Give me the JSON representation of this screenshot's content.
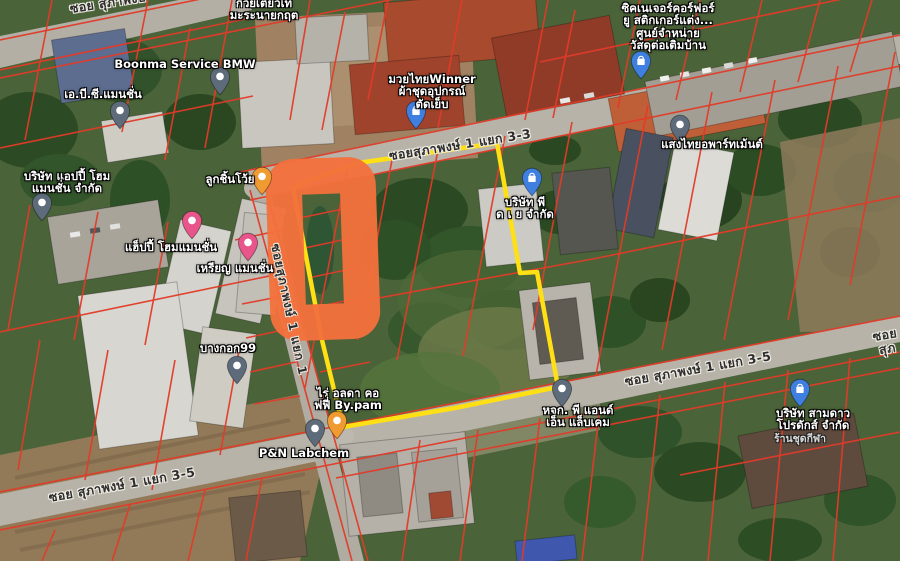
{
  "map": {
    "type": "satellite-with-cadastral-overlay",
    "overlays": {
      "parcel_line_color": "#e23b28",
      "plot_outline_color": "#ffe014",
      "highlight_marker_color": "#f3703c",
      "pin_generic_color": "#5d6b7b",
      "pin_shop_color": "#3f7fe0",
      "pin_food_color": "#f09a32",
      "pin_lodging_color": "#e8558a"
    },
    "road_labels": [
      {
        "text": "ซอย สุภาพงษ์"
      },
      {
        "text": "ซอยสุภาพงษ์ 1 แยก 3-3"
      },
      {
        "text": "ซอยสุภาพงษ์ 1 แยก 1"
      },
      {
        "text": "ซอย สุภาพงษ์ 1 แยก 3-5"
      },
      {
        "text": "ซอย สุภาพงษ์ 1 แยก 3-5"
      },
      {
        "text": "ซอย สุภ"
      }
    ],
    "pois": [
      {
        "name": "Boonma Service BMW",
        "pin": "generic"
      },
      {
        "name": "ก๋วยเตี๋ยวเท\nมะระนายกฤต",
        "pin": "none"
      },
      {
        "name": "เอ.บี.ซี.แมนชั่น",
        "pin": "generic"
      },
      {
        "name": "บริษัท แอปปี้ โฮม\nแมนชั่น จำกัด",
        "pin": "generic"
      },
      {
        "name": "ซิคเนเจอร์คอร์ฟอร์\nยู สติกเกอร์แต่ง...\nศูนย์จำหน่าย\nวัสดุต่อเติมบ้าน",
        "pin": "shop"
      },
      {
        "name": "มวยไทยWinner\nผ้าชุดอุปกรณ์\nตัดเย็บ",
        "pin": "shop"
      },
      {
        "name": "แสงไทยอพาร์ทเม้นต์",
        "pin": "generic"
      },
      {
        "name": "ลูกชิ้นโว้ย",
        "pin": "food"
      },
      {
        "name": "แฮ็ปปี้ โฮมแมนชั่น",
        "pin": "lodging"
      },
      {
        "name": "เหรียญ แมนชั่น",
        "pin": "lodging"
      },
      {
        "name": "บริษัท พี\nด เ ย จำกัด",
        "pin": "shop"
      },
      {
        "name": "บางกอก99",
        "pin": "generic"
      },
      {
        "name": "ไร่ อลดา คอ\nฟฟี่ By.pam",
        "pin": "food"
      },
      {
        "name": "P&N Labchem",
        "pin": "generic"
      },
      {
        "name": "หจก. พี แอนด์\nเอ็น แล็บเคม",
        "pin": "generic"
      },
      {
        "name": "บริษัท สามดาว\nโปรดักส์ จำกัด",
        "sub": "ร้านชุดกีฬา",
        "pin": "shop"
      }
    ]
  }
}
